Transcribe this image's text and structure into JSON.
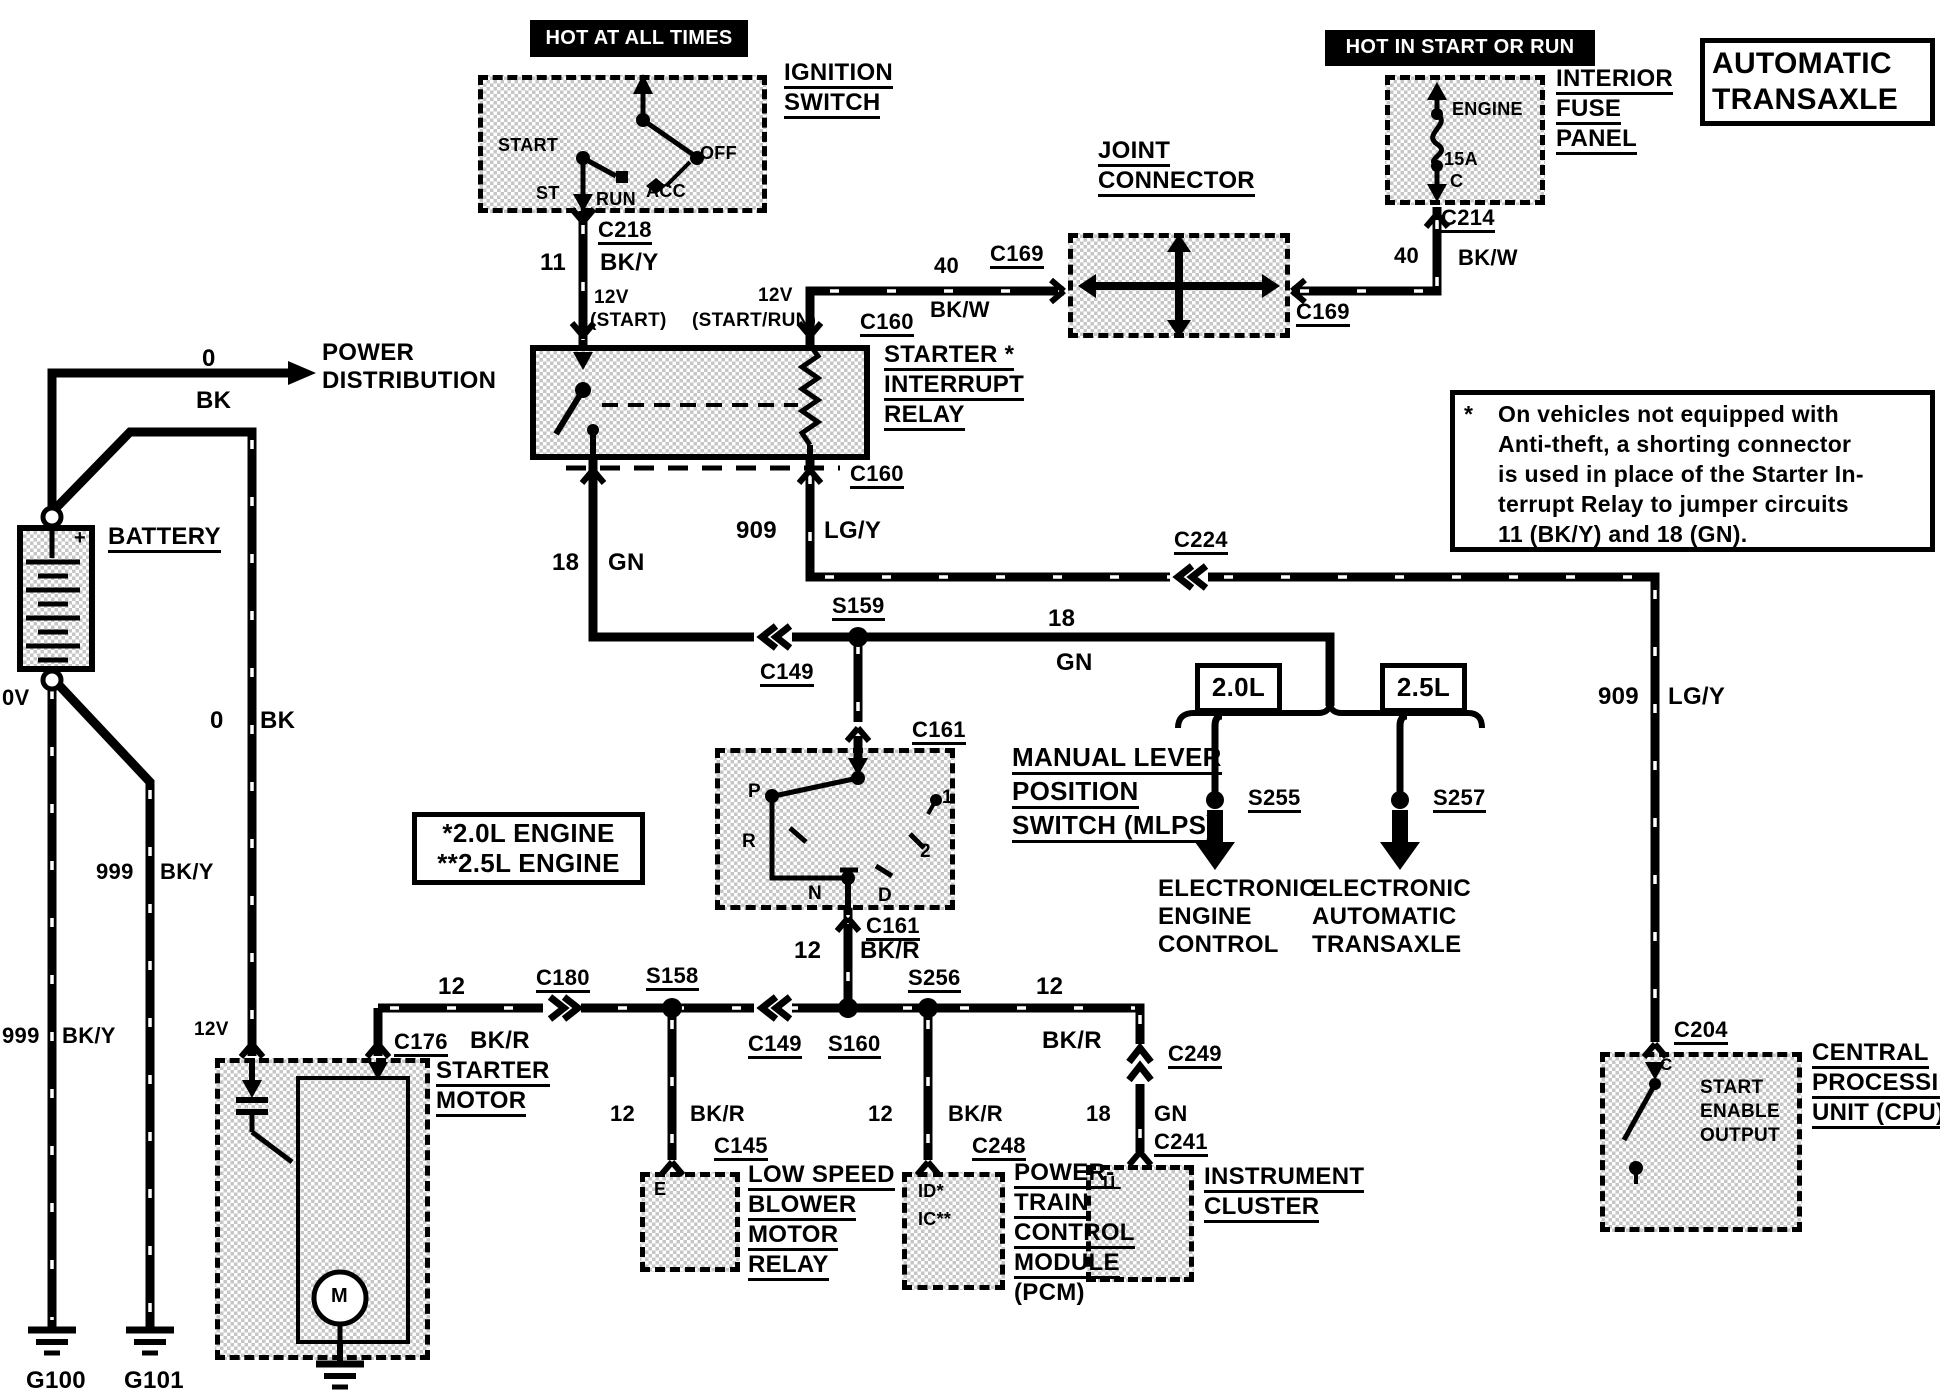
{
  "diagram": {
    "type": "automotive wiring diagram",
    "system": "Automatic Transaxle starting circuit"
  },
  "boxes": [
    {
      "n": "hot-at-all-times-box",
      "k": "black",
      "x": 530,
      "y": 20,
      "w": 218,
      "h": 37
    },
    {
      "n": "ignition-switch-box",
      "k": "dashed",
      "x": 478,
      "y": 75,
      "w": 289,
      "h": 138
    },
    {
      "n": "hot-in-start-or-run-box",
      "k": "black",
      "x": 1325,
      "y": 30,
      "w": 270,
      "h": 36
    },
    {
      "n": "interior-fuse-panel-box",
      "k": "dashed",
      "x": 1385,
      "y": 75,
      "w": 160,
      "h": 130
    },
    {
      "n": "automatic-transaxle-title-box",
      "k": "plain",
      "x": 1700,
      "y": 38,
      "w": 235,
      "h": 88
    },
    {
      "n": "joint-connector-box",
      "k": "dashed",
      "x": 1068,
      "y": 233,
      "w": 222,
      "h": 105
    },
    {
      "n": "starter-interrupt-relay-box",
      "k": "solid",
      "x": 530,
      "y": 345,
      "w": 340,
      "h": 115
    },
    {
      "n": "battery-box",
      "k": "solid",
      "x": 17,
      "y": 525,
      "w": 78,
      "h": 147
    },
    {
      "n": "note-box",
      "k": "plain",
      "x": 1450,
      "y": 390,
      "w": 485,
      "h": 162
    },
    {
      "n": "mlps-box",
      "k": "dashed",
      "x": 715,
      "y": 748,
      "w": 240,
      "h": 162
    },
    {
      "n": "engine-variants-box",
      "k": "plain",
      "x": 412,
      "y": 812,
      "w": 233,
      "h": 73
    },
    {
      "n": "box-2-0l",
      "k": "plain",
      "x": 1195,
      "y": 663,
      "w": 87,
      "h": 50
    },
    {
      "n": "box-2-5l",
      "k": "plain",
      "x": 1380,
      "y": 663,
      "w": 87,
      "h": 50
    },
    {
      "n": "starter-motor-box",
      "k": "dashed",
      "x": 215,
      "y": 1058,
      "w": 215,
      "h": 302
    },
    {
      "n": "blower-relay-box",
      "k": "dashed",
      "x": 640,
      "y": 1172,
      "w": 100,
      "h": 100
    },
    {
      "n": "pcm-box",
      "k": "dashed",
      "x": 902,
      "y": 1172,
      "w": 103,
      "h": 118
    },
    {
      "n": "instrument-cluster-box",
      "k": "dashed",
      "x": 1086,
      "y": 1165,
      "w": 108,
      "h": 117
    },
    {
      "n": "cpu-box",
      "k": "dashed",
      "x": 1600,
      "y": 1052,
      "w": 202,
      "h": 180
    }
  ],
  "labels": [
    {
      "n": "hot-at-all-times",
      "t": "HOT AT ALL TIMES",
      "x": 530,
      "y": 28,
      "s": 20,
      "w": 1,
      "wd": 218
    },
    {
      "n": "hot-in-start-or-run",
      "t": "HOT IN START OR RUN",
      "x": 1325,
      "y": 37,
      "s": 20,
      "w": 1,
      "wd": 270
    },
    {
      "n": "title-automatic",
      "t": "AUTOMATIC",
      "x": 1712,
      "y": 48,
      "s": 30
    },
    {
      "n": "title-transaxle",
      "t": "TRANSAXLE",
      "x": 1712,
      "y": 84,
      "s": 30
    },
    {
      "n": "ignition-switch-1",
      "t": "IGNITION",
      "x": 784,
      "y": 60,
      "s": 24,
      "u": 1
    },
    {
      "n": "ignition-switch-2",
      "t": "SWITCH",
      "x": 784,
      "y": 90,
      "s": 24,
      "u": 1
    },
    {
      "n": "ign-start",
      "t": "START",
      "x": 498,
      "y": 136,
      "s": 18
    },
    {
      "n": "ign-st",
      "t": "ST",
      "x": 536,
      "y": 184,
      "s": 18
    },
    {
      "n": "ign-run",
      "t": "RUN",
      "x": 596,
      "y": 190,
      "s": 18
    },
    {
      "n": "ign-acc",
      "t": "ACC",
      "x": 646,
      "y": 182,
      "s": 18
    },
    {
      "n": "ign-off",
      "t": "OFF",
      "x": 700,
      "y": 144,
      "s": 18
    },
    {
      "n": "conn-c218",
      "t": "C218",
      "x": 598,
      "y": 218,
      "s": 22,
      "u": 1
    },
    {
      "n": "wire-11",
      "t": "11",
      "x": 540,
      "y": 250,
      "s": 24
    },
    {
      "n": "wire-bky-top",
      "t": "BK/Y",
      "x": 600,
      "y": 250,
      "s": 24
    },
    {
      "n": "lbl-12v-start",
      "t": "12V",
      "x": 594,
      "y": 288,
      "s": 19
    },
    {
      "n": "lbl-start",
      "t": "(START)",
      "x": 590,
      "y": 311,
      "s": 19
    },
    {
      "n": "lbl-start-run",
      "t": "(START/RUN)",
      "x": 692,
      "y": 311,
      "s": 19
    },
    {
      "n": "lbl-12v-startrun",
      "t": "12V",
      "x": 758,
      "y": 286,
      "s": 19
    },
    {
      "n": "conn-c160-top",
      "t": "C160",
      "x": 860,
      "y": 310,
      "s": 22,
      "u": 1
    },
    {
      "n": "wire-40-left",
      "t": "40",
      "x": 934,
      "y": 254,
      "s": 22
    },
    {
      "n": "wire-bkw-left",
      "t": "BK/W",
      "x": 930,
      "y": 298,
      "s": 22
    },
    {
      "n": "conn-c169-left",
      "t": "C169",
      "x": 990,
      "y": 242,
      "s": 22,
      "u": 1
    },
    {
      "n": "joint-connector-1",
      "t": "JOINT",
      "x": 1098,
      "y": 138,
      "s": 24,
      "u": 1
    },
    {
      "n": "joint-connector-2",
      "t": "CONNECTOR",
      "x": 1098,
      "y": 168,
      "s": 24,
      "u": 1
    },
    {
      "n": "conn-c169-right",
      "t": "C169",
      "x": 1296,
      "y": 300,
      "s": 22,
      "u": 1
    },
    {
      "n": "wire-40-right",
      "t": "40",
      "x": 1394,
      "y": 244,
      "s": 22
    },
    {
      "n": "wire-bkw-right",
      "t": "BK/W",
      "x": 1458,
      "y": 246,
      "s": 22
    },
    {
      "n": "conn-c214",
      "t": "C214",
      "x": 1441,
      "y": 206,
      "s": 22,
      "u": 1
    },
    {
      "n": "interior-fuse-1",
      "t": "INTERIOR",
      "x": 1556,
      "y": 66,
      "s": 24,
      "u": 1
    },
    {
      "n": "interior-fuse-2",
      "t": "FUSE",
      "x": 1556,
      "y": 96,
      "s": 24,
      "u": 1
    },
    {
      "n": "interior-fuse-3",
      "t": "PANEL",
      "x": 1556,
      "y": 126,
      "s": 24,
      "u": 1
    },
    {
      "n": "fuse-engine",
      "t": "ENGINE",
      "x": 1452,
      "y": 100,
      "s": 18
    },
    {
      "n": "fuse-15a",
      "t": "15A",
      "x": 1444,
      "y": 150,
      "s": 18
    },
    {
      "n": "fuse-c",
      "t": "C",
      "x": 1450,
      "y": 172,
      "s": 18
    },
    {
      "n": "relay-label-1",
      "t": "STARTER *",
      "x": 884,
      "y": 342,
      "s": 24,
      "u": 1
    },
    {
      "n": "relay-label-2",
      "t": "INTERRUPT",
      "x": 884,
      "y": 372,
      "s": 24,
      "u": 1
    },
    {
      "n": "relay-label-3",
      "t": "RELAY",
      "x": 884,
      "y": 402,
      "s": 24,
      "u": 1
    },
    {
      "n": "conn-c160-bottom",
      "t": "C160",
      "x": 850,
      "y": 462,
      "s": 22,
      "u": 1
    },
    {
      "n": "power-distribution-1",
      "t": "POWER",
      "x": 322,
      "y": 340,
      "s": 24
    },
    {
      "n": "power-distribution-2",
      "t": "DISTRIBUTION",
      "x": 322,
      "y": 368,
      "s": 24
    },
    {
      "n": "wire-0-top",
      "t": "0",
      "x": 202,
      "y": 346,
      "s": 24
    },
    {
      "n": "wire-bk-top",
      "t": "BK",
      "x": 196,
      "y": 388,
      "s": 24
    },
    {
      "n": "battery-label",
      "t": "BATTERY",
      "x": 108,
      "y": 524,
      "s": 24,
      "u": 1
    },
    {
      "n": "battery-plus",
      "t": "+",
      "x": 74,
      "y": 528,
      "s": 20
    },
    {
      "n": "battery-0v",
      "t": "0V",
      "x": 2,
      "y": 686,
      "s": 22
    },
    {
      "n": "wire-0-mid",
      "t": "0",
      "x": 210,
      "y": 708,
      "s": 24
    },
    {
      "n": "wire-bk-mid",
      "t": "BK",
      "x": 260,
      "y": 708,
      "s": 24
    },
    {
      "n": "wire-999-a",
      "t": "999",
      "x": 96,
      "y": 860,
      "s": 22
    },
    {
      "n": "wire-bky-a",
      "t": "BK/Y",
      "x": 160,
      "y": 860,
      "s": 22
    },
    {
      "n": "wire-999-b",
      "t": "999",
      "x": 2,
      "y": 1024,
      "s": 22
    },
    {
      "n": "wire-bky-b",
      "t": "BK/Y",
      "x": 62,
      "y": 1024,
      "s": 22
    },
    {
      "n": "ground-g100",
      "t": "G100",
      "x": 26,
      "y": 1368,
      "s": 24,
      "u": 1
    },
    {
      "n": "ground-g101",
      "t": "G101",
      "x": 124,
      "y": 1368,
      "s": 24,
      "u": 1
    },
    {
      "n": "lbl-12v-starter",
      "t": "12V",
      "x": 194,
      "y": 1020,
      "s": 19
    },
    {
      "n": "conn-c176",
      "t": "C176",
      "x": 394,
      "y": 1030,
      "s": 22,
      "u": 1
    },
    {
      "n": "starter-motor-1",
      "t": "STARTER",
      "x": 436,
      "y": 1058,
      "s": 24,
      "u": 1
    },
    {
      "n": "starter-motor-2",
      "t": "MOTOR",
      "x": 436,
      "y": 1088,
      "s": 24,
      "u": 1
    },
    {
      "n": "motor-m",
      "t": "M",
      "x": 331,
      "y": 1286,
      "s": 20
    },
    {
      "n": "wire-18-left",
      "t": "18",
      "x": 552,
      "y": 550,
      "s": 24
    },
    {
      "n": "wire-gn-left",
      "t": "GN",
      "x": 608,
      "y": 550,
      "s": 24
    },
    {
      "n": "wire-909-top",
      "t": "909",
      "x": 736,
      "y": 518,
      "s": 24
    },
    {
      "n": "wire-lgy-top",
      "t": "LG/Y",
      "x": 824,
      "y": 518,
      "s": 24
    },
    {
      "n": "splice-s159",
      "t": "S159",
      "x": 832,
      "y": 594,
      "s": 22,
      "u": 1
    },
    {
      "n": "conn-c149-mid",
      "t": "C149",
      "x": 760,
      "y": 660,
      "s": 22,
      "u": 1
    },
    {
      "n": "wire-18-mid",
      "t": "18",
      "x": 1048,
      "y": 606,
      "s": 24
    },
    {
      "n": "wire-gn-mid",
      "t": "GN",
      "x": 1056,
      "y": 650,
      "s": 24
    },
    {
      "n": "conn-c224",
      "t": "C224",
      "x": 1174,
      "y": 528,
      "s": 22,
      "u": 1
    },
    {
      "n": "conn-c161-top",
      "t": "C161",
      "x": 912,
      "y": 718,
      "s": 22,
      "u": 1
    },
    {
      "n": "mlps-label-1",
      "t": "MANUAL LEVER",
      "x": 1012,
      "y": 744,
      "s": 26,
      "u": 1
    },
    {
      "n": "mlps-label-2",
      "t": "POSITION",
      "x": 1012,
      "y": 778,
      "s": 26,
      "u": 1
    },
    {
      "n": "mlps-label-3",
      "t": "SWITCH (MLPS)",
      "x": 1012,
      "y": 812,
      "s": 26,
      "u": 1
    },
    {
      "n": "mlps-p",
      "t": "P",
      "x": 748,
      "y": 782,
      "s": 19
    },
    {
      "n": "mlps-r",
      "t": "R",
      "x": 742,
      "y": 832,
      "s": 19
    },
    {
      "n": "mlps-n",
      "t": "N",
      "x": 808,
      "y": 884,
      "s": 19
    },
    {
      "n": "mlps-d",
      "t": "D",
      "x": 878,
      "y": 886,
      "s": 19
    },
    {
      "n": "mlps-2",
      "t": "2",
      "x": 920,
      "y": 842,
      "s": 19
    },
    {
      "n": "mlps-1",
      "t": "1",
      "x": 942,
      "y": 788,
      "s": 19
    },
    {
      "n": "conn-c161-bottom",
      "t": "C161",
      "x": 866,
      "y": 914,
      "s": 22,
      "u": 1
    },
    {
      "n": "wire-12-mlps",
      "t": "12",
      "x": 794,
      "y": 938,
      "s": 24
    },
    {
      "n": "wire-bkr-mlps",
      "t": "BK/R",
      "x": 860,
      "y": 938,
      "s": 24
    },
    {
      "n": "engine-variant-1",
      "t": "*2.0L ENGINE",
      "x": 412,
      "y": 820,
      "s": 26,
      "wd": 233
    },
    {
      "n": "engine-variant-2",
      "t": "**2.5L ENGINE",
      "x": 412,
      "y": 850,
      "s": 26,
      "wd": 233
    },
    {
      "n": "lbl-2-0l",
      "t": "2.0L",
      "x": 1195,
      "y": 674,
      "s": 26,
      "wd": 87
    },
    {
      "n": "lbl-2-5l",
      "t": "2.5L",
      "x": 1380,
      "y": 674,
      "s": 26,
      "wd": 87
    },
    {
      "n": "splice-s255",
      "t": "S255",
      "x": 1248,
      "y": 786,
      "s": 22,
      "u": 1
    },
    {
      "n": "splice-s257",
      "t": "S257",
      "x": 1433,
      "y": 786,
      "s": 22,
      "u": 1
    },
    {
      "n": "eec-label-1",
      "t": "ELECTRONIC",
      "x": 1158,
      "y": 876,
      "s": 24
    },
    {
      "n": "eec-label-2",
      "t": "ENGINE",
      "x": 1158,
      "y": 904,
      "s": 24
    },
    {
      "n": "eec-label-3",
      "t": "CONTROL",
      "x": 1158,
      "y": 932,
      "s": 24
    },
    {
      "n": "eat-label-1",
      "t": "ELECTRONIC",
      "x": 1312,
      "y": 876,
      "s": 24
    },
    {
      "n": "eat-label-2",
      "t": "AUTOMATIC",
      "x": 1312,
      "y": 904,
      "s": 24
    },
    {
      "n": "eat-label-3",
      "t": "TRANSAXLE",
      "x": 1312,
      "y": 932,
      "s": 24
    },
    {
      "n": "wire-12-bus-left",
      "t": "12",
      "x": 438,
      "y": 974,
      "s": 24
    },
    {
      "n": "wire-bkr-bus-left",
      "t": "BK/R",
      "x": 470,
      "y": 1028,
      "s": 24
    },
    {
      "n": "conn-c180",
      "t": "C180",
      "x": 536,
      "y": 966,
      "s": 22,
      "u": 1
    },
    {
      "n": "splice-s158",
      "t": "S158",
      "x": 646,
      "y": 964,
      "s": 22,
      "u": 1
    },
    {
      "n": "conn-c149-bus",
      "t": "C149",
      "x": 748,
      "y": 1032,
      "s": 22,
      "u": 1
    },
    {
      "n": "splice-s160",
      "t": "S160",
      "x": 828,
      "y": 1032,
      "s": 22,
      "u": 1
    },
    {
      "n": "splice-s256",
      "t": "S256",
      "x": 908,
      "y": 966,
      "s": 22,
      "u": 1
    },
    {
      "n": "wire-12-bus-right",
      "t": "12",
      "x": 1036,
      "y": 974,
      "s": 24
    },
    {
      "n": "wire-bkr-bus-right",
      "t": "BK/R",
      "x": 1042,
      "y": 1028,
      "s": 24
    },
    {
      "n": "wire-12-blower",
      "t": "12",
      "x": 610,
      "y": 1102,
      "s": 22
    },
    {
      "n": "wire-bkr-blower",
      "t": "BK/R",
      "x": 690,
      "y": 1102,
      "s": 22
    },
    {
      "n": "conn-c145",
      "t": "C145",
      "x": 714,
      "y": 1134,
      "s": 22,
      "u": 1
    },
    {
      "n": "blower-e",
      "t": "E",
      "x": 654,
      "y": 1180,
      "s": 18
    },
    {
      "n": "blower-label-1",
      "t": "LOW SPEED",
      "x": 748,
      "y": 1162,
      "s": 24,
      "u": 1
    },
    {
      "n": "blower-label-2",
      "t": "BLOWER",
      "x": 748,
      "y": 1192,
      "s": 24,
      "u": 1
    },
    {
      "n": "blower-label-3",
      "t": "MOTOR",
      "x": 748,
      "y": 1222,
      "s": 24,
      "u": 1
    },
    {
      "n": "blower-label-4",
      "t": "RELAY",
      "x": 748,
      "y": 1252,
      "s": 24,
      "u": 1
    },
    {
      "n": "wire-12-pcm",
      "t": "12",
      "x": 868,
      "y": 1102,
      "s": 22
    },
    {
      "n": "wire-bkr-pcm",
      "t": "BK/R",
      "x": 948,
      "y": 1102,
      "s": 22
    },
    {
      "n": "conn-c248",
      "t": "C248",
      "x": 972,
      "y": 1134,
      "s": 22,
      "u": 1
    },
    {
      "n": "pcm-id",
      "t": "ID*",
      "x": 918,
      "y": 1182,
      "s": 18
    },
    {
      "n": "pcm-ic",
      "t": "IC**",
      "x": 918,
      "y": 1210,
      "s": 18
    },
    {
      "n": "pcm-label-1",
      "t": "POWER-",
      "x": 1014,
      "y": 1160,
      "s": 24,
      "u": 1
    },
    {
      "n": "pcm-label-2",
      "t": "TRAIN",
      "x": 1014,
      "y": 1190,
      "s": 24,
      "u": 1
    },
    {
      "n": "pcm-label-3",
      "t": "CONTROL",
      "x": 1014,
      "y": 1220,
      "s": 24,
      "u": 1
    },
    {
      "n": "pcm-label-4",
      "t": "MODULE",
      "x": 1014,
      "y": 1250,
      "s": 24,
      "u": 1
    },
    {
      "n": "pcm-label-5",
      "t": "(PCM)",
      "x": 1014,
      "y": 1280,
      "s": 24
    },
    {
      "n": "conn-c249",
      "t": "C249",
      "x": 1168,
      "y": 1042,
      "s": 22,
      "u": 1
    },
    {
      "n": "wire-18-cluster",
      "t": "18",
      "x": 1086,
      "y": 1102,
      "s": 22
    },
    {
      "n": "wire-gn-cluster",
      "t": "GN",
      "x": 1154,
      "y": 1102,
      "s": 22
    },
    {
      "n": "conn-c241",
      "t": "C241",
      "x": 1154,
      "y": 1130,
      "s": 22,
      "u": 1
    },
    {
      "n": "cluster-1l",
      "t": "1L",
      "x": 1100,
      "y": 1174,
      "s": 18
    },
    {
      "n": "cluster-label-1",
      "t": "INSTRUMENT",
      "x": 1204,
      "y": 1164,
      "s": 24,
      "u": 1
    },
    {
      "n": "cluster-label-2",
      "t": "CLUSTER",
      "x": 1204,
      "y": 1194,
      "s": 24,
      "u": 1
    },
    {
      "n": "wire-909-right",
      "t": "909",
      "x": 1598,
      "y": 684,
      "s": 24
    },
    {
      "n": "wire-lgy-right",
      "t": "LG/Y",
      "x": 1668,
      "y": 684,
      "s": 24
    },
    {
      "n": "conn-c204",
      "t": "C204",
      "x": 1674,
      "y": 1018,
      "s": 22,
      "u": 1
    },
    {
      "n": "cpu-c",
      "t": "C",
      "x": 1660,
      "y": 1056,
      "s": 17
    },
    {
      "n": "cpu-start",
      "t": "START",
      "x": 1700,
      "y": 1078,
      "s": 19
    },
    {
      "n": "cpu-enable",
      "t": "ENABLE",
      "x": 1700,
      "y": 1102,
      "s": 19
    },
    {
      "n": "cpu-output",
      "t": "OUTPUT",
      "x": 1700,
      "y": 1126,
      "s": 19
    },
    {
      "n": "cpu-label-1",
      "t": "CENTRAL",
      "x": 1812,
      "y": 1040,
      "s": 24,
      "u": 1
    },
    {
      "n": "cpu-label-2",
      "t": "PROCESSING",
      "x": 1812,
      "y": 1070,
      "s": 24,
      "u": 1
    },
    {
      "n": "cpu-label-3",
      "t": "UNIT (CPU)",
      "x": 1812,
      "y": 1100,
      "s": 24,
      "u": 1
    },
    {
      "n": "note-asterisk",
      "t": "*",
      "x": 1464,
      "y": 402,
      "s": 23
    },
    {
      "n": "note-line-1",
      "t": "On vehicles not equipped with",
      "x": 1498,
      "y": 402,
      "s": 23
    },
    {
      "n": "note-line-2",
      "t": "Anti-theft, a shorting connector",
      "x": 1498,
      "y": 432,
      "s": 23
    },
    {
      "n": "note-line-3",
      "t": "is used in place of the Starter In-",
      "x": 1498,
      "y": 462,
      "s": 23
    },
    {
      "n": "note-line-4",
      "t": "terrupt Relay to jumper circuits",
      "x": 1498,
      "y": 492,
      "s": 23
    },
    {
      "n": "note-line-5",
      "t": "11 (BK/Y) and 18 (GN).",
      "x": 1498,
      "y": 522,
      "s": 23
    }
  ]
}
